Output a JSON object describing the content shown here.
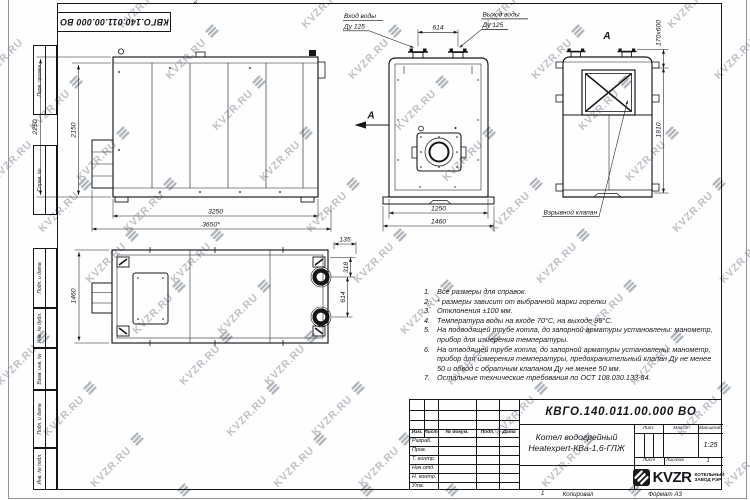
{
  "page": {
    "stamp_number": "КВГО.140.011.00.000 ВО",
    "fold_mark_top": "2",
    "fold_mark_bottom": "1",
    "footer": {
      "copied": "Копировал",
      "format": "Формат А3"
    }
  },
  "watermark": {
    "text": "KVZR.RU",
    "text_color": "#b5bac0",
    "logo_color": "#a9afb5"
  },
  "margin_fields": {
    "labels": [
      "Перв. примен.",
      "Справ. №",
      "Подп. и дата",
      "Инв. № дубл.",
      "Взам. инв. №",
      "Подп. и дата",
      "Инв. № подл."
    ]
  },
  "views": {
    "side": {
      "dim_height_outer": "2250",
      "dim_height_inner": "2150",
      "dim_length_inner": "3250",
      "dim_length_outer": "3650*"
    },
    "top": {
      "dim_width": "1460",
      "dim_edge": "135",
      "dim_pipe": "318",
      "dim_pipes": "614"
    },
    "front": {
      "arrow_label": "А",
      "inlet_line1": "Вход воды",
      "inlet_line2": "Ду 125",
      "outlet_line1": "Выход воды",
      "outlet_line2": "Ду 125",
      "dim_pipes": "614",
      "dim_width_inner": "1250",
      "dim_width_outer": "1460"
    },
    "rear": {
      "view_label": "А",
      "dim_valve": "170х600",
      "dim_height": "1910",
      "valve_label": "Взрывной клапан"
    }
  },
  "notes": {
    "items": [
      {
        "n": "1.",
        "t": "Все размеры для справок."
      },
      {
        "n": "2.",
        "t": "* размеры зависит от выбранной марки горелки"
      },
      {
        "n": "3.",
        "t": "Отклонения ±100 мм."
      },
      {
        "n": "4.",
        "t": "Температура воды на входе 70°С, на выходе 95°С."
      },
      {
        "n": "5.",
        "t": "На подводящей трубе котла, до запорной арматуры установлены: манометр, прибор для измерения температуры."
      },
      {
        "n": "6.",
        "t": "На отводящей трубе котла, до запорной арматуры установлены: манометр, прибор для измерения температуры, предохранительный клапан Ду не менее 50 и обвод с обратным клапаном Ду не менее 50 мм."
      },
      {
        "n": "7.",
        "t": "Остальные технические требования по ОСТ 108.030.133-84."
      }
    ]
  },
  "title_block": {
    "doc_number": "КВГО.140.011.00.000 ВО",
    "product_line1": "Котел водогрейный",
    "product_line2": "Heatexpert-КВа-1,6-ГЛЖ",
    "header_cols": [
      "Изм.",
      "Лист",
      "№ докум.",
      "Подп.",
      "Дата"
    ],
    "rows": [
      "Разраб.",
      "Пров.",
      "Т. контр.",
      "Нач.отд.",
      "Н. контр.",
      "Утв."
    ],
    "lit_label": "Лит.",
    "mass_label": "Масса",
    "scale_label": "Масштаб",
    "scale_value": "1:25",
    "sheet_label": "Лист",
    "sheets_label": "Листов",
    "sheets_value": "1",
    "company": {
      "name": "KVZR",
      "sub1": "КОТЕЛЬНЫЙ",
      "sub2": "ЗАВОД РЭР"
    }
  }
}
